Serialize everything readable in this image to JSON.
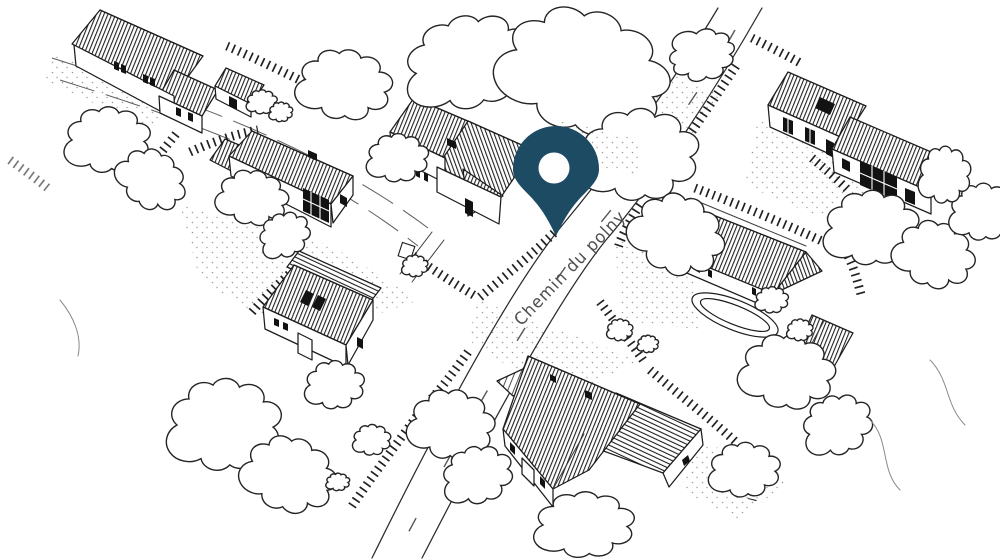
{
  "map": {
    "street_label": "Chemin du polny",
    "pin": {
      "icon": "location-pin-icon",
      "color": "#1d4b63"
    },
    "colors": {
      "background": "#ffffff",
      "ink": "#1c1c1c",
      "street_label": "#4f4f4f"
    }
  }
}
